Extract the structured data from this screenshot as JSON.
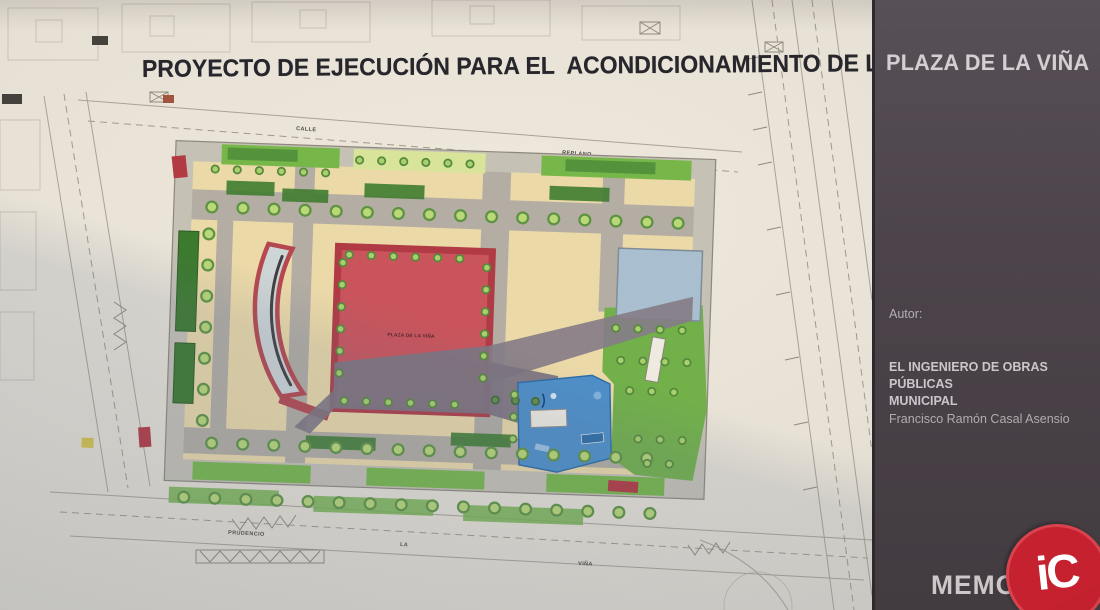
{
  "document": {
    "title_main": "PROYECTO DE EJECUCIÓN PARA EL  ACONDICIONAMIENTO DE LA",
    "title_highlight": "PLAZA DE LA VIÑA"
  },
  "sidebar": {
    "title": "PLAZA DE LA VIÑA",
    "author_label": "Autor:",
    "author_role_line1": "EL INGENIERO DE OBRAS PÚBLICAS",
    "author_role_line2": "MUNICIPAL",
    "author_name": "Francisco Ramón Casal Asensio",
    "document_label": "MEMORIA",
    "logo_text": "iC"
  },
  "plan": {
    "plaza_center_label": "PLAZA DE LA VIÑA",
    "street_labels": {
      "top_left": "CALLE",
      "top_right": "REPLANO",
      "bottom_left": "PRUDENCIO",
      "bottom_mid": "LA",
      "bottom_right": "VIÑA"
    },
    "colors": {
      "paper": "#e8e2d6",
      "sidebar_panel": "#4a4248",
      "plaza_ground": "#ecd9a8",
      "path_gray": "#b3ada3",
      "green_strip": "#77b74a",
      "tree_green": "#b9d877",
      "square_red": "#c9545c",
      "shadow_violet": "#847b85",
      "pond_blue": "#a9bfd0",
      "playground_blue": "#4e8fc9",
      "marker_red": "#b23a42",
      "logo_red": "#c5212e"
    }
  }
}
